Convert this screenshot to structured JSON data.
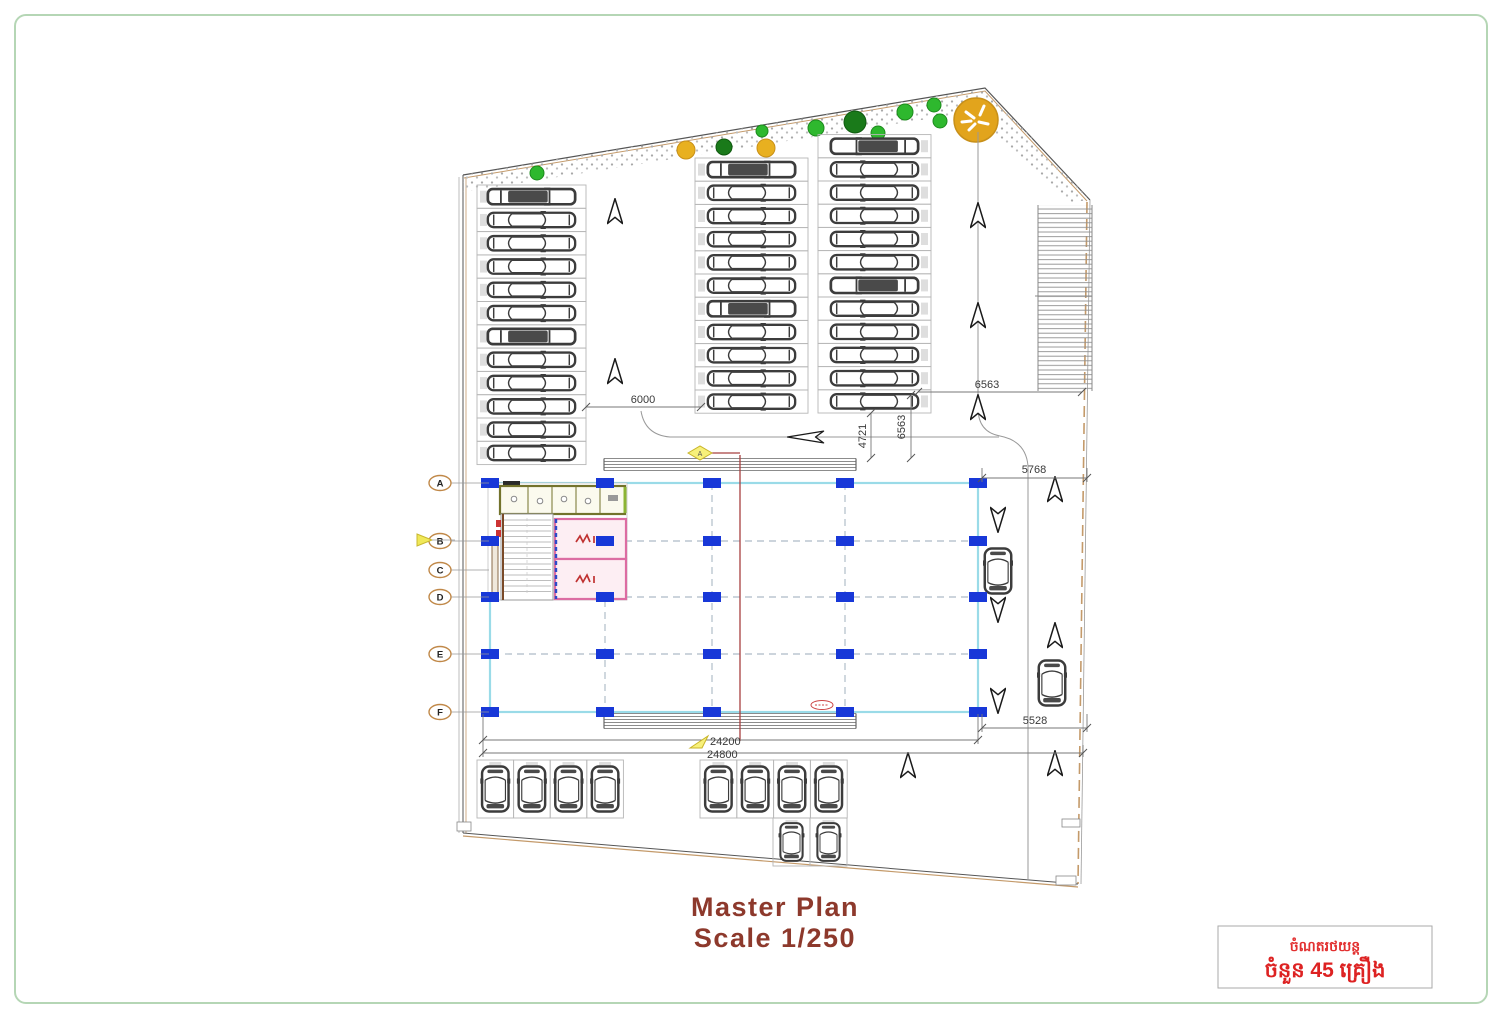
{
  "drawing": {
    "title": "Master Plan",
    "scale_label": "Scale 1/250",
    "stamp": {
      "line1": "ចំណតរថយន្ត",
      "line2": "ចំនួន 45 គ្រឿង"
    },
    "grid_rows": [
      "A",
      "B",
      "C",
      "D",
      "E",
      "F"
    ],
    "dimensions": {
      "aisle_width": "6000",
      "east_drive_width": "6563",
      "setback_front": "4721",
      "setback_front2": "6563",
      "drive_northeast": "5768",
      "drive_southeast": "5528",
      "building_span_inner": "24200",
      "building_span_outer": "24800"
    },
    "section_marker": "A",
    "colors": {
      "page_border": "#b5d6b5",
      "boundary": "#4a4a4a",
      "boundary_tan": "#c49a6a",
      "building_outline_cyan": "#9adbe8",
      "column_blue": "#1838d8",
      "title_red": "#8d392c",
      "stamp_red": "#e23030",
      "tree_green": "#2eb82e",
      "tree_dark_green": "#1a7a1a",
      "tree_yellow": "#e8b020",
      "lift_room_pink": "#dc6ca2"
    }
  },
  "parking": {
    "groups": [
      {
        "id": "north-left",
        "count": 12
      },
      {
        "id": "north-center",
        "count": 11
      },
      {
        "id": "north-east",
        "count": 12
      },
      {
        "id": "south-west",
        "count": 4
      },
      {
        "id": "south-east",
        "count": 4
      },
      {
        "id": "south-east-lower",
        "count": 2
      },
      {
        "id": "east-lane-moving",
        "count": 2
      }
    ]
  }
}
